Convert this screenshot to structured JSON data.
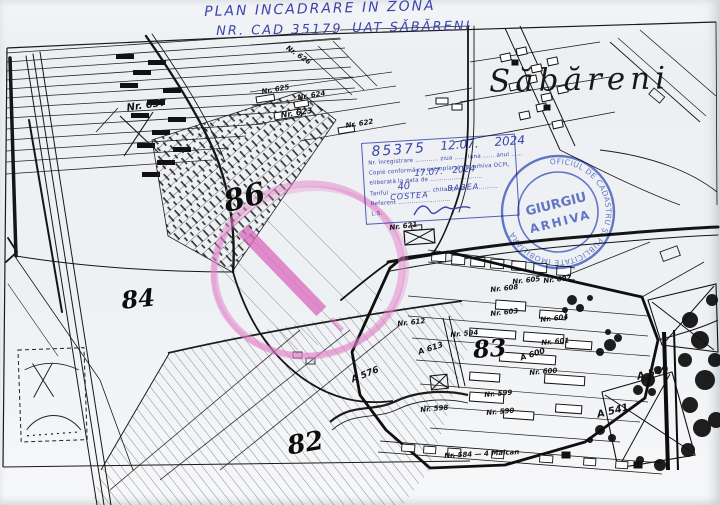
{
  "map": {
    "place_label": "Săbăreni",
    "highlight_color": "#dd6ec2",
    "labels": [
      {
        "t": "86",
        "x": 220,
        "y": 186,
        "s": 30,
        "r": -14,
        "cls": "zone"
      },
      {
        "t": "84",
        "x": 120,
        "y": 286,
        "s": 24,
        "r": -6,
        "cls": "zone"
      },
      {
        "t": "83",
        "x": 472,
        "y": 335,
        "s": 24,
        "r": -4,
        "cls": "zone"
      },
      {
        "t": "82",
        "x": 285,
        "y": 432,
        "s": 26,
        "r": -10,
        "cls": "zone"
      },
      {
        "t": "Nr. 637",
        "x": 126,
        "y": 103,
        "s": 10,
        "r": -8
      },
      {
        "t": "Nr. 626",
        "x": 289,
        "y": 44,
        "s": 7,
        "r": 34
      },
      {
        "t": "Nr. 625",
        "x": 261,
        "y": 88,
        "s": 7,
        "r": -10
      },
      {
        "t": "Nr. 624",
        "x": 297,
        "y": 94,
        "s": 7,
        "r": -10
      },
      {
        "t": "Nr. 623",
        "x": 280,
        "y": 111,
        "s": 8,
        "r": -9
      },
      {
        "t": "Nr. 622",
        "x": 345,
        "y": 122,
        "s": 7,
        "r": -9
      },
      {
        "t": "Nr. 621",
        "x": 389,
        "y": 224,
        "s": 7,
        "r": -7
      },
      {
        "t": "Nr. 612",
        "x": 397,
        "y": 320,
        "s": 7,
        "r": -6
      },
      {
        "t": "A 613",
        "x": 417,
        "y": 348,
        "s": 8,
        "r": -18
      },
      {
        "t": "Nr. 594",
        "x": 450,
        "y": 331,
        "s": 7,
        "r": -5
      },
      {
        "t": "Nr. 608",
        "x": 490,
        "y": 286,
        "s": 7,
        "r": -6
      },
      {
        "t": "Nr. 605",
        "x": 512,
        "y": 278,
        "s": 7,
        "r": -6
      },
      {
        "t": "Nr. 607",
        "x": 543,
        "y": 277,
        "s": 7,
        "r": -6
      },
      {
        "t": "Nr. 603",
        "x": 490,
        "y": 310,
        "s": 7,
        "r": -6
      },
      {
        "t": "Nr. 604",
        "x": 540,
        "y": 316,
        "s": 7,
        "r": -6
      },
      {
        "t": "Nr. 601",
        "x": 541,
        "y": 339,
        "s": 7,
        "r": -5
      },
      {
        "t": "A 600",
        "x": 519,
        "y": 354,
        "s": 8,
        "r": -18
      },
      {
        "t": "Nr. 600",
        "x": 529,
        "y": 369,
        "s": 7,
        "r": -5
      },
      {
        "t": "Nr. 599",
        "x": 484,
        "y": 391,
        "s": 7,
        "r": -5
      },
      {
        "t": "Nr. 598",
        "x": 420,
        "y": 406,
        "s": 7,
        "r": -5
      },
      {
        "t": "Nr. 590",
        "x": 486,
        "y": 409,
        "s": 7,
        "r": -5
      },
      {
        "t": "A 576",
        "x": 350,
        "y": 376,
        "s": 9,
        "r": -22
      },
      {
        "t": "A 549",
        "x": 636,
        "y": 372,
        "s": 10,
        "r": -14
      },
      {
        "t": "A 541",
        "x": 596,
        "y": 410,
        "s": 10,
        "r": -14
      },
      {
        "t": "Nr. 584 — 4 Maican",
        "x": 444,
        "y": 452,
        "s": 7,
        "r": -3
      }
    ]
  },
  "hand": {
    "ink_color": "#3b43ad",
    "items": [
      {
        "t": "PLAN  INCADRARE  IN  ZONA",
        "x": 204,
        "y": 4,
        "s": 14,
        "r": -1.5,
        "ls": 2
      },
      {
        "t": "NR. CAD  35179",
        "x": 216,
        "y": 24,
        "s": 13,
        "r": -1,
        "ls": 2
      },
      {
        "t": "UAT  SĂBĂRENI",
        "x": 352,
        "y": 21,
        "s": 13,
        "r": -1,
        "ls": 2
      },
      {
        "t": "85375",
        "x": 371,
        "y": 144,
        "s": 14,
        "r": -4,
        "ls": 2
      },
      {
        "t": "12.07.",
        "x": 440,
        "y": 139,
        "s": 12,
        "r": -4
      },
      {
        "t": "2024",
        "x": 494,
        "y": 135,
        "s": 12,
        "r": -4
      },
      {
        "t": "17.07.",
        "x": 414,
        "y": 169,
        "s": 9,
        "r": -4
      },
      {
        "t": "2024",
        "x": 452,
        "y": 166,
        "s": 9,
        "r": -4
      },
      {
        "t": "40",
        "x": 397,
        "y": 182,
        "s": 10,
        "r": -6
      },
      {
        "t": "COSTEA",
        "x": 390,
        "y": 193,
        "s": 8,
        "r": -4,
        "ls": 1
      },
      {
        "t": "BABEA",
        "x": 447,
        "y": 184,
        "s": 8,
        "r": -4,
        "ls": 1
      }
    ]
  },
  "stamp_box": {
    "color": "#3d4cb6",
    "rows": [
      "Nr. înregistrare …………  ziua ……  luna ……  anul ……",
      "Copie conformă cu exemplarul din arhiva OCPI,",
      "eliberată la data de ………………………",
      "Tariful …………………  chitanța nr. ……………",
      "Referent ………………………",
      "L.S."
    ]
  },
  "round_stamp": {
    "color": "#4760c4",
    "rim_text": "OFICIUL DE CADASTRU ȘI PUBLICITATE IMOBILIARĂ",
    "line1": "GIURGIU",
    "line2": "ARHIVA"
  }
}
